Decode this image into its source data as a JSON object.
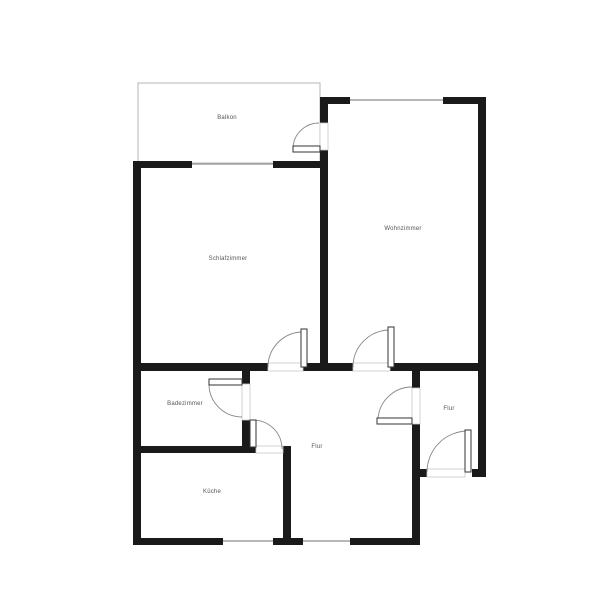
{
  "rooms": [
    {
      "id": "balkon",
      "label": "Balkon",
      "x": 227,
      "y": 118
    },
    {
      "id": "schlafzimmer",
      "label": "Schlafzimmer",
      "x": 228,
      "y": 259
    },
    {
      "id": "wohnzimmer",
      "label": "Wohnzimmer",
      "x": 403,
      "y": 229
    },
    {
      "id": "badezimmer",
      "label": "Badezimmer",
      "x": 185,
      "y": 404
    },
    {
      "id": "flur",
      "label": "Flur",
      "x": 317,
      "y": 447
    },
    {
      "id": "flur-eingang",
      "label": "Flur",
      "x": 449,
      "y": 409
    },
    {
      "id": "kueche",
      "label": "Küche",
      "x": 212,
      "y": 492
    }
  ],
  "colors": {
    "background": "#ffffff",
    "wall": "#1a1a1a",
    "window": "#a0a0a0",
    "balcony_outline": "#b5b5b5",
    "opening_stroke": "#c8c8c8",
    "door_leaf_fill": "#ffffff",
    "door_leaf_stroke": "#333333",
    "door_arc": "#888888",
    "label": "#555555"
  },
  "floorplan": {
    "canvas": {
      "width": 600,
      "height": 600
    },
    "balcony": {
      "x": 138,
      "y": 83,
      "w": 182,
      "h": 80
    },
    "walls": [
      {
        "x": 133,
        "y": 161,
        "w": 8,
        "h": 384
      },
      {
        "x": 133,
        "y": 161,
        "w": 59,
        "h": 7
      },
      {
        "x": 273,
        "y": 161,
        "w": 47,
        "h": 7
      },
      {
        "x": 320,
        "y": 97,
        "w": 8,
        "h": 26
      },
      {
        "x": 320,
        "y": 150,
        "w": 8,
        "h": 221
      },
      {
        "x": 320,
        "y": 97,
        "w": 30,
        "h": 7
      },
      {
        "x": 443,
        "y": 97,
        "w": 43,
        "h": 7
      },
      {
        "x": 478,
        "y": 97,
        "w": 8,
        "h": 380
      },
      {
        "x": 133,
        "y": 363,
        "w": 135,
        "h": 8
      },
      {
        "x": 303,
        "y": 363,
        "w": 50,
        "h": 8
      },
      {
        "x": 390,
        "y": 363,
        "w": 96,
        "h": 8
      },
      {
        "x": 242,
        "y": 363,
        "w": 8,
        "h": 21
      },
      {
        "x": 242,
        "y": 420,
        "w": 8,
        "h": 32
      },
      {
        "x": 133,
        "y": 446,
        "w": 123,
        "h": 7
      },
      {
        "x": 283,
        "y": 446,
        "w": 8,
        "h": 99
      },
      {
        "x": 412,
        "y": 363,
        "w": 8,
        "h": 25
      },
      {
        "x": 412,
        "y": 424,
        "w": 8,
        "h": 121
      },
      {
        "x": 133,
        "y": 538,
        "w": 90,
        "h": 7
      },
      {
        "x": 273,
        "y": 538,
        "w": 30,
        "h": 7
      },
      {
        "x": 350,
        "y": 538,
        "w": 70,
        "h": 7
      },
      {
        "x": 412,
        "y": 469,
        "w": 15,
        "h": 8
      },
      {
        "x": 472,
        "y": 469,
        "w": 14,
        "h": 8
      }
    ],
    "windows": [
      {
        "name": "schlafzimmer-window",
        "x1": 192,
        "y1": 164,
        "x2": 273,
        "y2": 164
      },
      {
        "name": "wohnzimmer-window",
        "x1": 350,
        "y1": 100,
        "x2": 443,
        "y2": 100
      },
      {
        "name": "kueche-window",
        "x1": 223,
        "y1": 541,
        "x2": 273,
        "y2": 541
      },
      {
        "name": "flur-window",
        "x1": 303,
        "y1": 541,
        "x2": 350,
        "y2": 541
      }
    ],
    "openings": [
      {
        "x": 320,
        "y": 123,
        "w": 8,
        "h": 27
      },
      {
        "x": 268,
        "y": 363,
        "w": 35,
        "h": 8
      },
      {
        "x": 353,
        "y": 363,
        "w": 37,
        "h": 8
      },
      {
        "x": 242,
        "y": 384,
        "w": 8,
        "h": 36
      },
      {
        "x": 256,
        "y": 446,
        "w": 27,
        "h": 7
      },
      {
        "x": 412,
        "y": 388,
        "w": 8,
        "h": 36
      },
      {
        "x": 427,
        "y": 469,
        "w": 38,
        "h": 8
      }
    ],
    "doors": [
      {
        "name": "balcony-door",
        "leaf": {
          "x": 293,
          "y": 146,
          "w": 27,
          "h": 6
        },
        "arc": "M 293 149 A 26 26 0 0 1 319 123"
      },
      {
        "name": "schlafzimmer-door",
        "leaf": {
          "x": 301,
          "y": 329,
          "w": 6,
          "h": 38
        },
        "arc": "M 268 367 A 35 35 0 0 1 303 332"
      },
      {
        "name": "wohnzimmer-door",
        "leaf": {
          "x": 388,
          "y": 327,
          "w": 6,
          "h": 40
        },
        "arc": "M 353 367 A 37 37 0 0 1 390 330"
      },
      {
        "name": "badezimmer-door",
        "leaf": {
          "x": 209,
          "y": 379,
          "w": 33,
          "h": 6
        },
        "arc": "M 209 384 A 33 33 0 0 0 242 417"
      },
      {
        "name": "kueche-door",
        "leaf": {
          "x": 250,
          "y": 420,
          "w": 6,
          "h": 27
        },
        "arc": "M 253 420 A 29 29 0 0 1 282 449"
      },
      {
        "name": "flur-door",
        "leaf": {
          "x": 377,
          "y": 418,
          "w": 35,
          "h": 6
        },
        "arc": "M 378 421 A 34 34 0 0 1 412 387"
      },
      {
        "name": "entrance-door",
        "leaf": {
          "x": 465,
          "y": 430,
          "w": 6,
          "h": 42
        },
        "arc": "M 427 472 A 41 41 0 0 1 468 431"
      }
    ]
  }
}
